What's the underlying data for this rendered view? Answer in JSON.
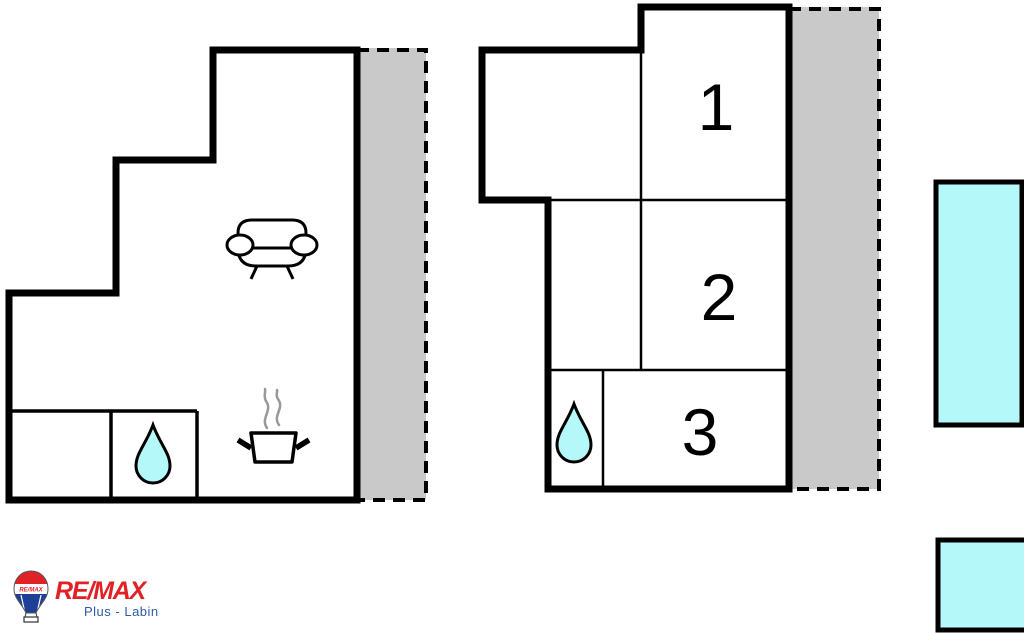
{
  "colors": {
    "wall": "#000000",
    "terrace": "#c9c9c9",
    "water": "#b4f8fa",
    "steam": "#999999",
    "remax_red": "#e02227",
    "remax_blue": "#1e3f96",
    "office_blue": "#2d5ba9"
  },
  "plan_left": {
    "name": "apartment-unit-left",
    "icons": {
      "sofa": "sofa-icon",
      "stove": "cooking-pot-icon",
      "water": "water-drop-icon"
    }
  },
  "plan_right": {
    "name": "apartment-unit-right",
    "rooms": [
      {
        "label": "1"
      },
      {
        "label": "2"
      },
      {
        "label": "3"
      }
    ],
    "icons": {
      "water": "water-drop-icon"
    }
  },
  "logo": {
    "brand": "RE/MAX",
    "balloon_text": "RE/MAX",
    "office": "Plus - Labin"
  }
}
